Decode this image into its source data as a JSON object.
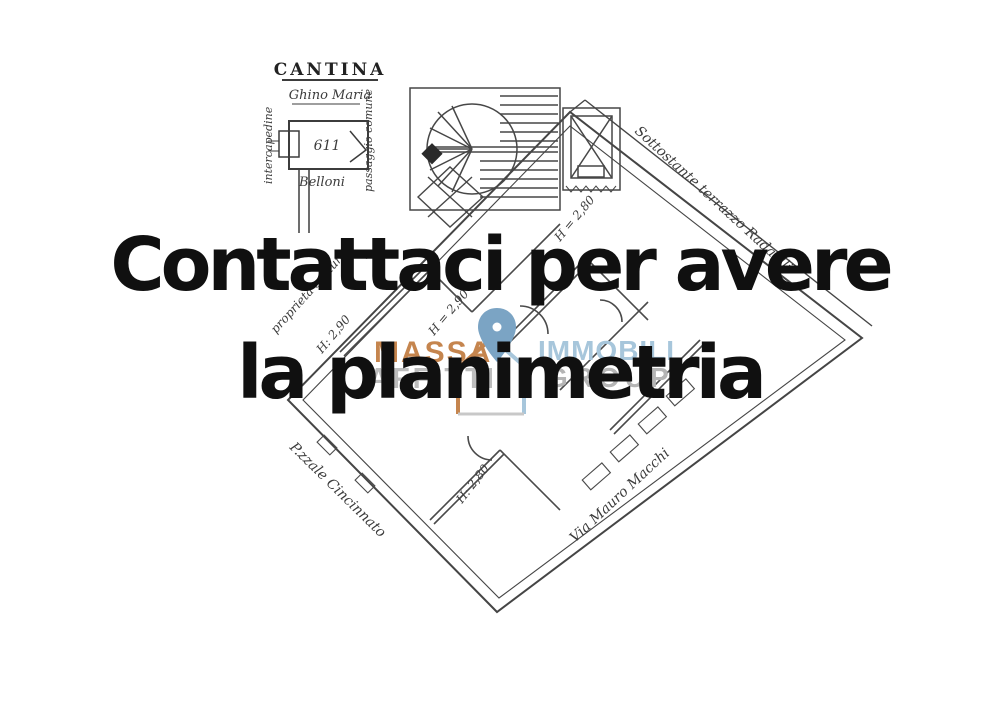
{
  "overlay": {
    "line1": "Contattaci per avere",
    "line2": "la planimetria",
    "text_color": "#101010"
  },
  "watermark": {
    "massa": "MASSA",
    "affitti": "AFFITTI",
    "immobili": "IMMOBILI",
    "group": "GROUP",
    "colors": {
      "massa": "#c5854e",
      "affitti": "#bdbdbd",
      "immobili": "#a7c6db",
      "group": "#b5b5b5",
      "pin": "#7ba4c4",
      "house_left": "#c5854e",
      "house_right": "#a7c6db"
    }
  },
  "floorplan": {
    "ink_color": "#454545",
    "inset": {
      "title": "CANTINA",
      "owner": "Ghino Maria",
      "left_note": "intercapedine",
      "right_note": "passaggio comune",
      "bottom_note": "Belloni",
      "unit": "611"
    },
    "labels": {
      "terrace": "Sottostante terrazzo Radaelli",
      "street_right": "Via Mauro Macchi",
      "street_left": "P.zzale Cincinnato",
      "common": "proprietà comune",
      "h1": "H: 2,90",
      "h2": "H = 2,90",
      "h3": "H = 2,80",
      "h4": "H: 2,80"
    }
  }
}
